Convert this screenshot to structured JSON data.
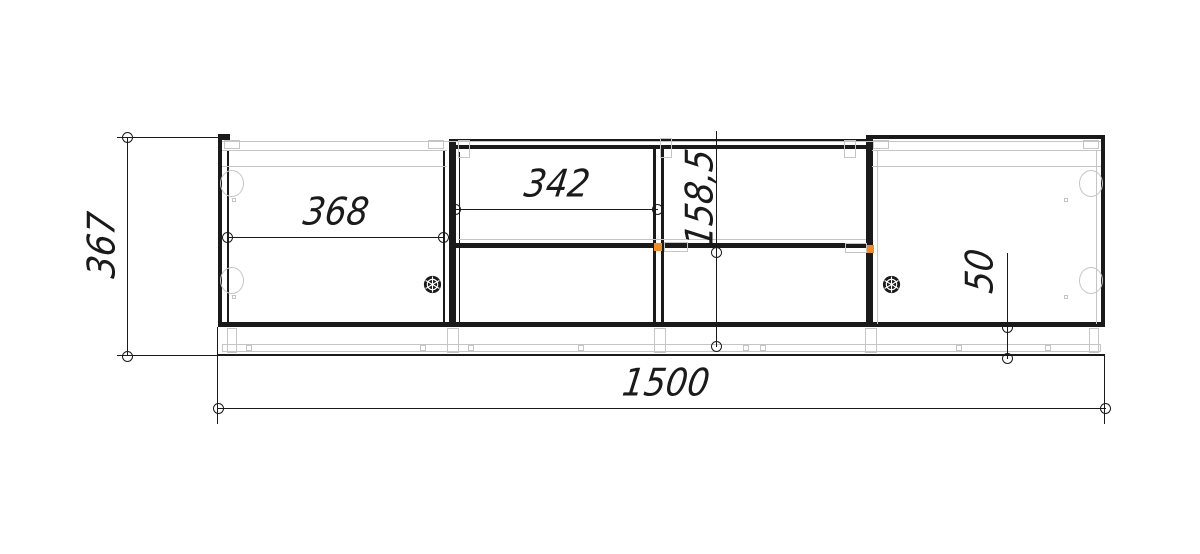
{
  "drawing": {
    "labels": {
      "overall_width": "1500",
      "overall_height": "367",
      "left_door_width": "368",
      "middle_opening_width": "342",
      "middle_shelf_offset": "158,5",
      "plinth_height": "50"
    },
    "colors": {
      "line": "#1a1a1a",
      "construction": "#c5c5c5",
      "selected_fitting": "#f08c21",
      "background": "#ffffff"
    }
  }
}
